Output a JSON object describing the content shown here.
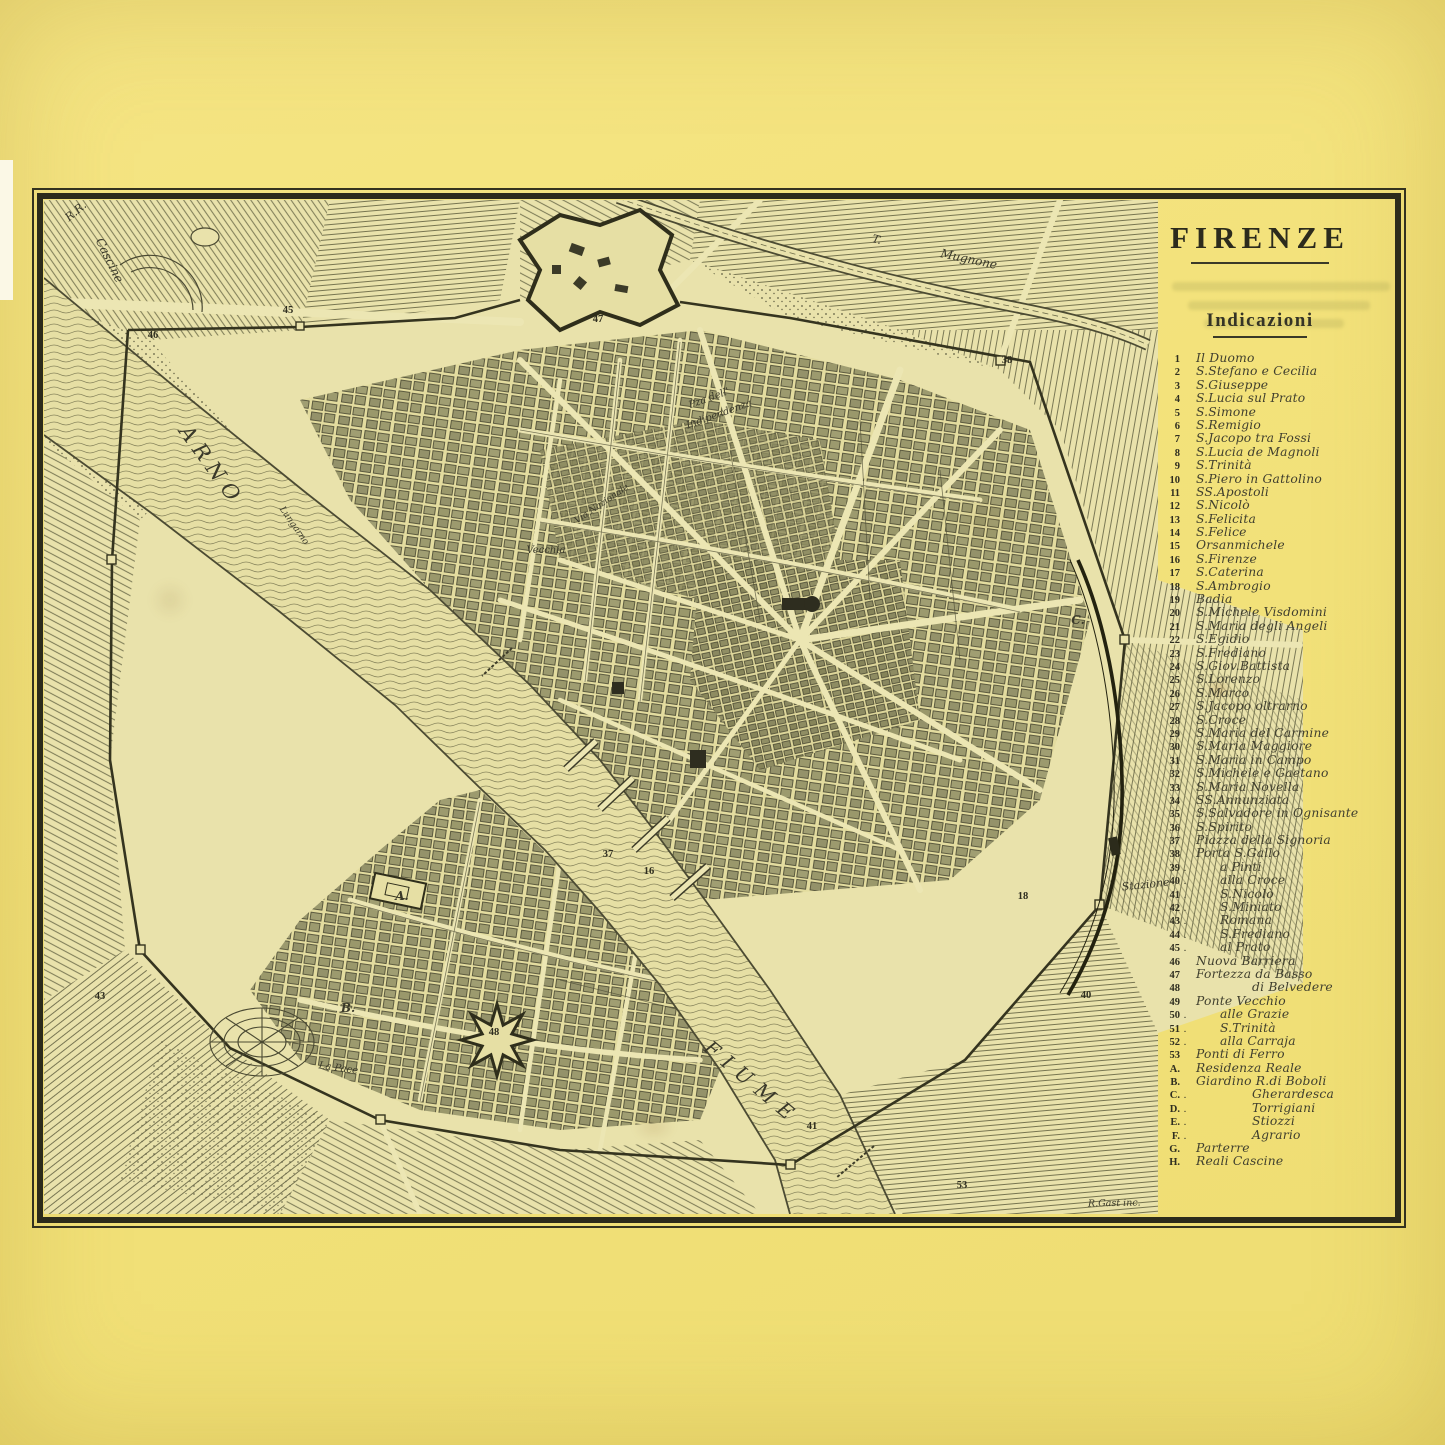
{
  "title": {
    "text": "FIRENZE"
  },
  "legend": {
    "heading": "Indicazioni",
    "items": [
      {
        "n": "1",
        "t": "Il Duomo"
      },
      {
        "n": "2",
        "t": "S.Stefano e Cecilia"
      },
      {
        "n": "3",
        "t": "S.Giuseppe"
      },
      {
        "n": "4",
        "t": "S.Lucia sul Prato"
      },
      {
        "n": "5",
        "t": "S.Simone"
      },
      {
        "n": "6",
        "t": "S.Remigio"
      },
      {
        "n": "7",
        "t": "S.Jacopo tra Fossi"
      },
      {
        "n": "8",
        "t": "S.Lucia de Magnoli"
      },
      {
        "n": "9",
        "t": "S.Trinità"
      },
      {
        "n": "10",
        "t": "S.Piero in Gattolino"
      },
      {
        "n": "11",
        "t": "SS.Apostoli"
      },
      {
        "n": "12",
        "t": "S.Nicolò"
      },
      {
        "n": "13",
        "t": "S.Felicita"
      },
      {
        "n": "14",
        "t": "S.Felice"
      },
      {
        "n": "15",
        "t": "Orsanmichele"
      },
      {
        "n": "16",
        "t": "S.Firenze"
      },
      {
        "n": "17",
        "t": "S.Caterina"
      },
      {
        "n": "18",
        "t": "S.Ambrogio"
      },
      {
        "n": "19",
        "t": "Badia"
      },
      {
        "n": "20",
        "t": "S.Michele Visdomini"
      },
      {
        "n": "21",
        "t": "S.Maria degli Angeli"
      },
      {
        "n": "22",
        "t": "S.Egidio"
      },
      {
        "n": "23",
        "t": "S.Frediano"
      },
      {
        "n": "24",
        "t": "S.Giov.Battista"
      },
      {
        "n": "25",
        "t": "S.Lorenzo"
      },
      {
        "n": "26",
        "t": "S.Marco"
      },
      {
        "n": "27",
        "t": "S.Jacopo oltrarno"
      },
      {
        "n": "28",
        "t": "S.Croce"
      },
      {
        "n": "29",
        "t": "S.Maria del Carmine"
      },
      {
        "n": "30",
        "t": "S.Maria Maggiore"
      },
      {
        "n": "31",
        "t": "S.Maria in Campo"
      },
      {
        "n": "32",
        "t": "S.Michele e Gaetano"
      },
      {
        "n": "33",
        "t": "S.Maria Novella"
      },
      {
        "n": "34",
        "t": "SS.Annunziata"
      },
      {
        "n": "35",
        "t": "S.Salvadore in Ognisante"
      },
      {
        "n": "36",
        "t": "S.Spirito"
      },
      {
        "n": "37",
        "t": "Piazza della Signoria"
      },
      {
        "n": "38",
        "t": "Porta S.Gallo"
      },
      {
        "n": "39",
        "d": 1,
        "i": 1,
        "t": "a Pinti"
      },
      {
        "n": "40",
        "d": 1,
        "i": 1,
        "t": "alla Croce"
      },
      {
        "n": "41",
        "d": 1,
        "i": 1,
        "t": "S.Nicolò"
      },
      {
        "n": "42",
        "d": 1,
        "i": 1,
        "t": "S.Miniato"
      },
      {
        "n": "43",
        "d": 1,
        "i": 1,
        "t": "Romana"
      },
      {
        "n": "44",
        "d": 1,
        "i": 1,
        "t": "S.Frediano"
      },
      {
        "n": "45",
        "d": 1,
        "i": 1,
        "t": "al Prato"
      },
      {
        "n": "46",
        "t": "Nuova Barriera"
      },
      {
        "n": "47",
        "t": "Fortezza da Basso"
      },
      {
        "n": "48",
        "i": 2,
        "t": "di Belvedere"
      },
      {
        "n": "49",
        "t": "Ponte Vecchio"
      },
      {
        "n": "50",
        "d": 1,
        "i": 1,
        "t": "alle Grazie"
      },
      {
        "n": "51",
        "d": 1,
        "i": 1,
        "t": "S.Trinità"
      },
      {
        "n": "52",
        "d": 1,
        "i": 1,
        "t": "alla Carraja"
      },
      {
        "n": "53",
        "t": "Ponti di Ferro"
      },
      {
        "n": "A.",
        "t": "Residenza Reale"
      },
      {
        "n": "B.",
        "t": "Giardino R.di Boboli"
      },
      {
        "n": "C.",
        "d": 1,
        "i": 2,
        "t": "Gherardesca"
      },
      {
        "n": "D.",
        "d": 1,
        "i": 2,
        "t": "Torrigiani"
      },
      {
        "n": "E.",
        "d": 1,
        "i": 2,
        "t": "Stiozzi"
      },
      {
        "n": "F.",
        "d": 1,
        "i": 2,
        "t": "Agrario"
      },
      {
        "n": "G.",
        "t": "Parterre"
      },
      {
        "n": "H.",
        "t": "Reali Cascine"
      }
    ]
  },
  "map_labels": [
    {
      "text": "R.R.",
      "x": 78,
      "y": 214,
      "rot": -40,
      "size": 11
    },
    {
      "text": "Cascine",
      "x": 106,
      "y": 262,
      "rot": 64,
      "size": 12
    },
    {
      "text": "ARNO",
      "x": 206,
      "y": 470,
      "rot": 54,
      "size": 21,
      "ls": 7
    },
    {
      "text": "FIUME",
      "x": 748,
      "y": 1088,
      "rot": 40,
      "size": 20,
      "ls": 9
    },
    {
      "text": "T.",
      "x": 876,
      "y": 243,
      "rot": 14,
      "size": 11
    },
    {
      "text": "Mugnone",
      "x": 968,
      "y": 263,
      "rot": 12,
      "size": 12
    },
    {
      "text": "Pza dell'",
      "x": 710,
      "y": 401,
      "rot": -20,
      "size": 10
    },
    {
      "text": "Indipendenza",
      "x": 720,
      "y": 417,
      "rot": -20,
      "size": 10
    },
    {
      "text": "Vecchia",
      "x": 546,
      "y": 553,
      "rot": 0,
      "size": 10
    },
    {
      "text": "Via Nazionale",
      "x": 603,
      "y": 506,
      "rot": -34,
      "size": 9
    },
    {
      "text": "Lungarno",
      "x": 292,
      "y": 527,
      "rot": 55,
      "size": 9
    },
    {
      "text": "Stazione",
      "x": 1146,
      "y": 888,
      "rot": -6,
      "size": 11
    },
    {
      "text": "La Pace",
      "x": 338,
      "y": 1071,
      "rot": 8,
      "size": 10
    },
    {
      "text": "A.",
      "x": 402,
      "y": 900,
      "size": 12,
      "b": 1
    },
    {
      "text": "B.",
      "x": 348,
      "y": 1012,
      "size": 12,
      "b": 1
    },
    {
      "text": "C.",
      "x": 1078,
      "y": 624,
      "size": 12,
      "b": 1
    }
  ],
  "map_numbers": [
    {
      "n": "46",
      "x": 153,
      "y": 338
    },
    {
      "n": "45",
      "x": 288,
      "y": 313
    },
    {
      "n": "47",
      "x": 598,
      "y": 322
    },
    {
      "n": "38",
      "x": 1007,
      "y": 363
    },
    {
      "n": "18",
      "x": 1023,
      "y": 899
    },
    {
      "n": "40",
      "x": 1086,
      "y": 998
    },
    {
      "n": "41",
      "x": 812,
      "y": 1129
    },
    {
      "n": "53",
      "x": 962,
      "y": 1188
    },
    {
      "n": "48",
      "x": 494,
      "y": 1035
    },
    {
      "n": "43",
      "x": 100,
      "y": 999
    },
    {
      "n": "37",
      "x": 608,
      "y": 857
    },
    {
      "n": "16",
      "x": 649,
      "y": 874
    }
  ],
  "signature": {
    "text": "R.Gast inc."
  },
  "colors": {
    "paper": "#f3e27b",
    "map_base": "#e9e2ab",
    "ink": "#2c2b1d",
    "hatch": "#6a6948",
    "legend_text": "#403f2e"
  }
}
